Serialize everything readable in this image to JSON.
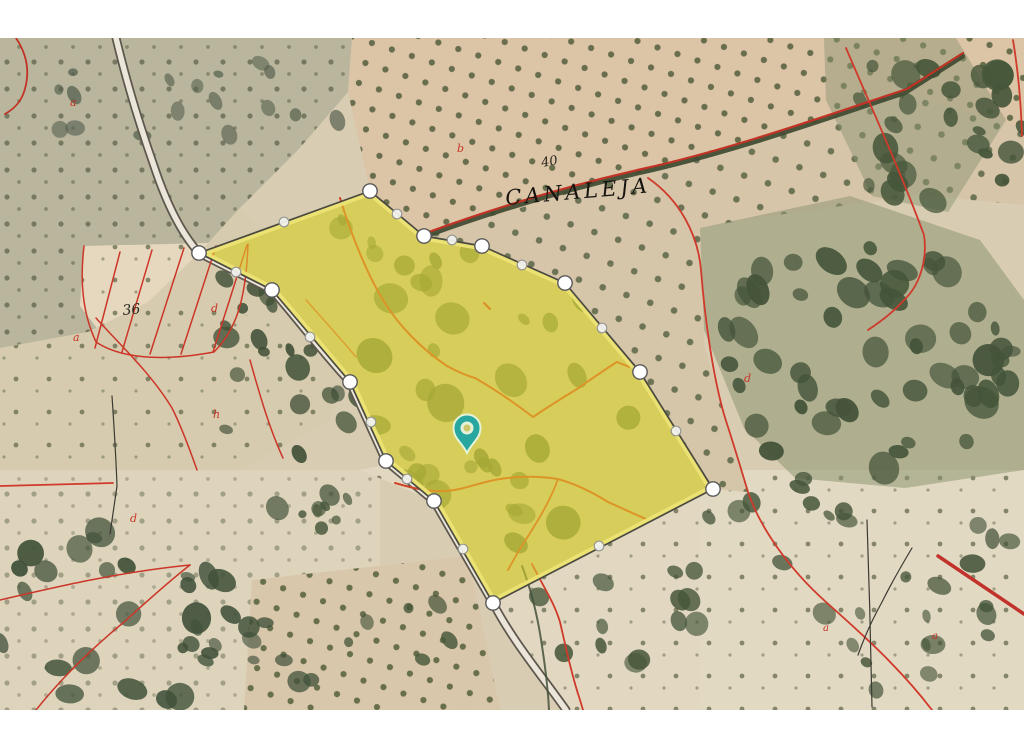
{
  "map": {
    "labels": [
      {
        "text": "a",
        "x": 70,
        "y": 106,
        "size": 11,
        "color": "#c63526",
        "rotate": 0
      },
      {
        "text": "b",
        "x": 457,
        "y": 152,
        "size": 11,
        "color": "#c63526",
        "rotate": 0
      },
      {
        "text": "40",
        "x": 542,
        "y": 167,
        "size": 13,
        "color": "#2a261e",
        "rotate": -10
      },
      {
        "text": "CANALEJA",
        "x": 506,
        "y": 205,
        "size": 21,
        "color": "#17140f",
        "rotate": -5,
        "spacing": 3.5
      },
      {
        "text": "36",
        "x": 123,
        "y": 315,
        "size": 14,
        "color": "#2a261e",
        "rotate": -6
      },
      {
        "text": "d",
        "x": 211,
        "y": 312,
        "size": 11,
        "color": "#c63526",
        "rotate": 0
      },
      {
        "text": "a",
        "x": 73,
        "y": 341,
        "size": 11,
        "color": "#c63526",
        "rotate": 0
      },
      {
        "text": "h",
        "x": 213,
        "y": 418,
        "size": 11,
        "color": "#c63526",
        "rotate": 0
      },
      {
        "text": "d",
        "x": 130,
        "y": 522,
        "size": 11,
        "color": "#c63526",
        "rotate": 0
      },
      {
        "text": "d",
        "x": 744,
        "y": 382,
        "size": 11,
        "color": "#c63526",
        "rotate": 0
      },
      {
        "text": "a",
        "x": 823,
        "y": 631,
        "size": 10,
        "color": "#c63526",
        "rotate": 0
      },
      {
        "text": "a",
        "x": 932,
        "y": 639,
        "size": 10,
        "color": "#c63526",
        "rotate": 0
      }
    ],
    "parcel": {
      "fill": "#ece428",
      "fill_opacity": 0.5,
      "outline": "#4a4a40",
      "rim": "#ece3c2",
      "under_fill": "#c3b78e",
      "vertices": [
        [
          370,
          191
        ],
        [
          424,
          236
        ],
        [
          482,
          246
        ],
        [
          565,
          283
        ],
        [
          640,
          372
        ],
        [
          713,
          489
        ],
        [
          493,
          603
        ],
        [
          434,
          501
        ],
        [
          386,
          461
        ],
        [
          350,
          382
        ],
        [
          272,
          290
        ],
        [
          199,
          253
        ]
      ],
      "midpoints": [
        [
          397,
          214
        ],
        [
          452,
          240
        ],
        [
          522,
          265
        ],
        [
          602,
          328
        ],
        [
          676,
          431
        ],
        [
          599,
          546
        ],
        [
          463,
          549
        ],
        [
          407,
          479
        ],
        [
          371,
          422
        ],
        [
          310,
          337
        ],
        [
          236,
          272
        ],
        [
          284,
          222
        ]
      ],
      "vertex_style": {
        "radius": 7.2,
        "fill": "#ffffff",
        "stroke": "#5a5a5a"
      },
      "midpoint_style": {
        "radius": 4.8,
        "fill": "#f1f1ee",
        "stroke": "#94948f"
      }
    },
    "pin": {
      "x": 467,
      "y": 453,
      "color": "#28a7a0",
      "ring": "#e4f3d7",
      "hole": "#cdc66a"
    },
    "cadastral_line_color": "#c8352a"
  }
}
